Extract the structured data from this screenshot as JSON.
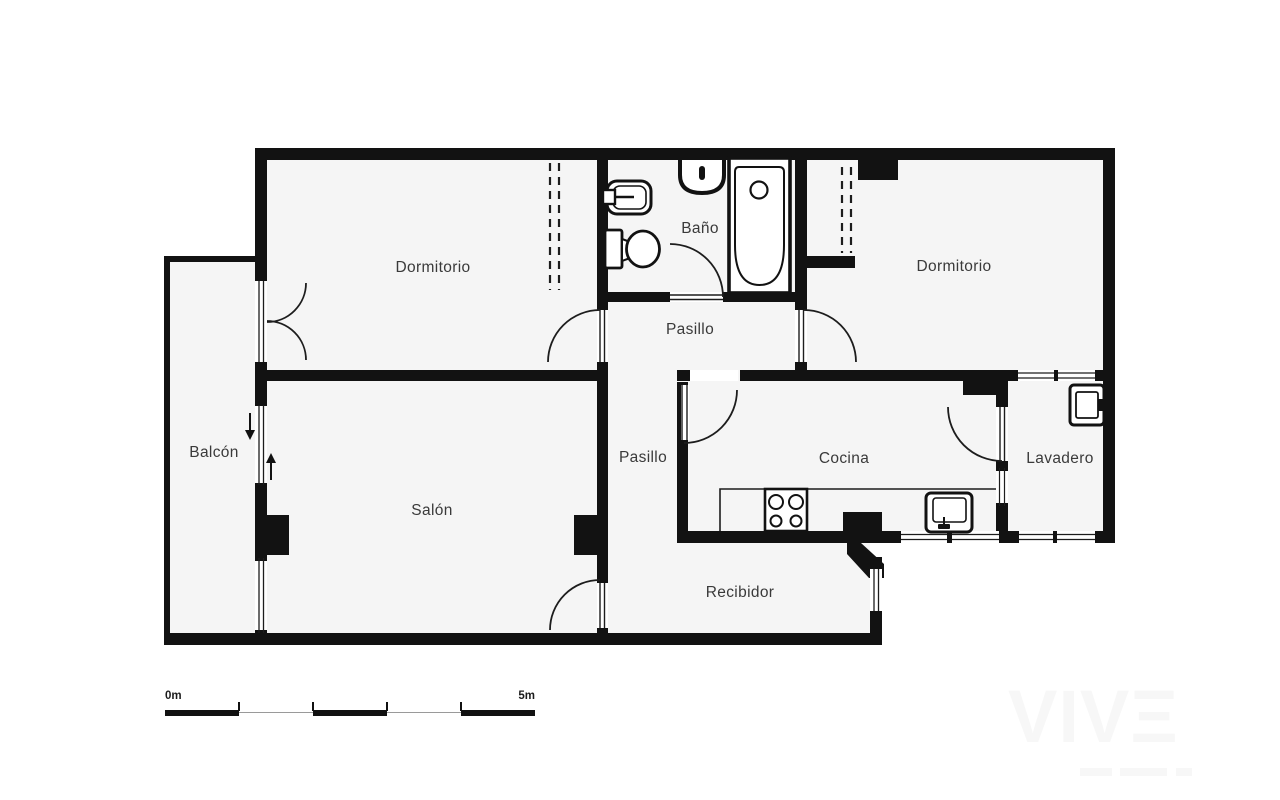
{
  "plan": {
    "title": "apartment-floor-plan",
    "rooms": [
      {
        "id": "dormitorio-1",
        "label": "Dormitorio"
      },
      {
        "id": "bano",
        "label": "Baño"
      },
      {
        "id": "dormitorio-2",
        "label": "Dormitorio"
      },
      {
        "id": "pasillo-1",
        "label": "Pasillo"
      },
      {
        "id": "balcon",
        "label": "Balcón"
      },
      {
        "id": "salon",
        "label": "Salón"
      },
      {
        "id": "pasillo-2",
        "label": "Pasillo"
      },
      {
        "id": "cocina",
        "label": "Cocina"
      },
      {
        "id": "lavadero",
        "label": "Lavadero"
      },
      {
        "id": "recibidor",
        "label": "Recibidor"
      }
    ],
    "fixtures": [
      "bidet",
      "bathroom-sink",
      "toilet",
      "bathtub",
      "kitchen-counter",
      "stove",
      "kitchen-sink",
      "washing-machine"
    ],
    "features": [
      "french-door-balcony",
      "sliding-door-balcony",
      "wardrobe-dormitorio-1",
      "wardrobe-dormitorio-2",
      "entrance-door",
      "windows"
    ],
    "colors": {
      "wall": "#121212",
      "room_fill": "#f5f5f5",
      "line": "#1d1d1d",
      "label": "#3a3a3a"
    }
  },
  "scale_bar": {
    "start_label": "0m",
    "end_label": "5m",
    "meters": 5
  },
  "watermark": {
    "text": "VIVΞ"
  }
}
